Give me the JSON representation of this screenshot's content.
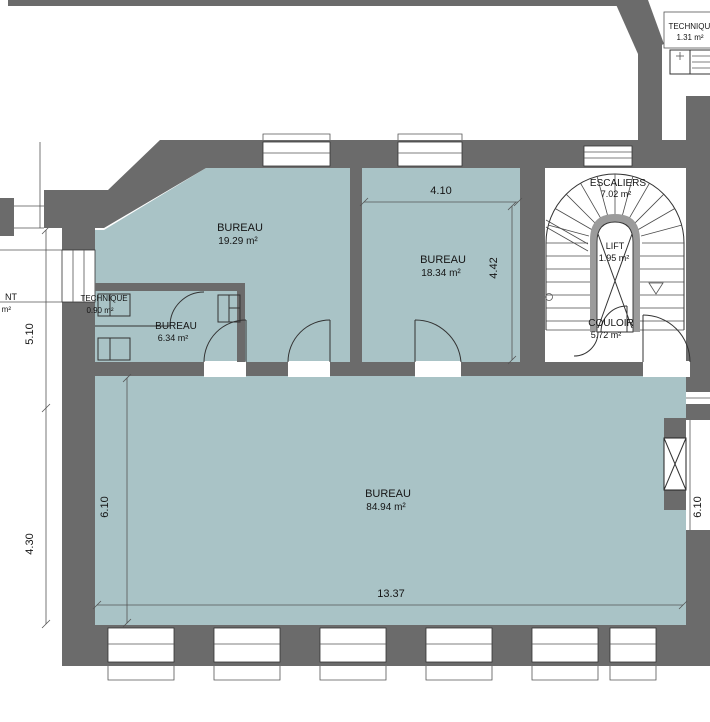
{
  "colors": {
    "wall": "#6b6b6b",
    "room_fill": "#a9c3c6",
    "lift_wall": "#9b9b9b",
    "line": "#333333"
  },
  "rooms": {
    "bureau19": {
      "name": "BUREAU",
      "area": "19.29 m²"
    },
    "bureau18": {
      "name": "BUREAU",
      "area": "18.34 m²"
    },
    "bureau6": {
      "name": "BUREAU",
      "area": "6.34 m²"
    },
    "bureau84": {
      "name": "BUREAU",
      "area": "84.94 m²"
    },
    "escaliers": {
      "name": "ESCALIERS",
      "area": "7.02 m²"
    },
    "lift": {
      "name": "LIFT",
      "area": "1.95 m²"
    },
    "couloir": {
      "name": "COULOIR",
      "area": "5.72 m²"
    },
    "techniqueTopRight": {
      "name": "TECHNIQUE",
      "area": "1.31 m²"
    },
    "techniqueLeft": {
      "name": "TECHNIQUE",
      "area": "0.90 m²"
    },
    "partialLeft": {
      "name": "NT",
      "area": "m²"
    }
  },
  "dimensions": {
    "bureau18Width": "4.10",
    "bureau18Height": "4.42",
    "leftUpper": "5.10",
    "leftLower": "4.30",
    "bureau84HeightLeft": "6.10",
    "bureau84HeightRight": "6.10",
    "bureau84Width": "13.37"
  }
}
